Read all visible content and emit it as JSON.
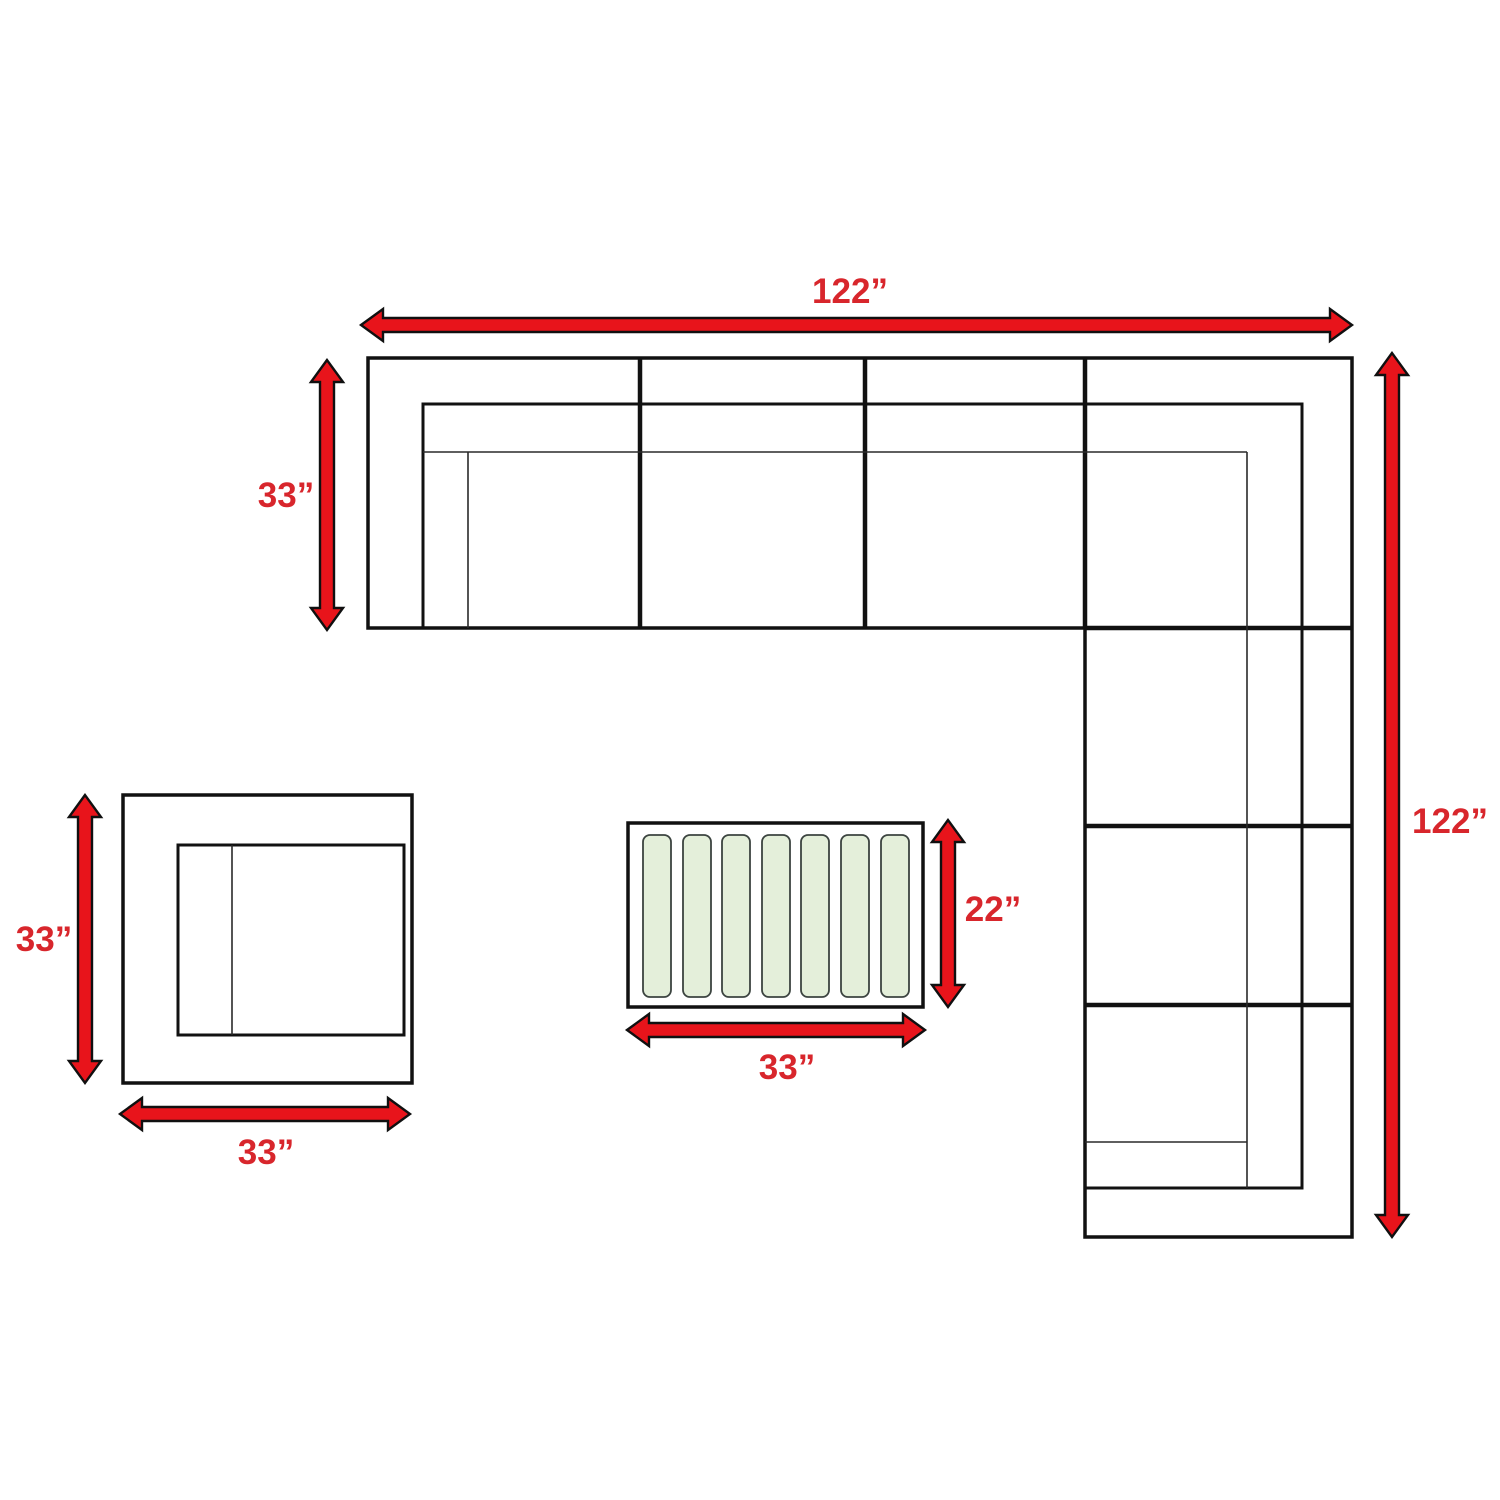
{
  "diagram": {
    "type": "furniture-dimension-diagram",
    "accent_color": "#e8141b",
    "label_color": "#d8262c",
    "line_color": "#111111",
    "slat_fill": "#e4efda",
    "sectional": {
      "width_label": "122”",
      "depth_label": "33”",
      "length_label": "122”"
    },
    "chair": {
      "depth_label": "33”",
      "width_label": "33”"
    },
    "table": {
      "depth_label": "22”",
      "width_label": "33”"
    }
  }
}
